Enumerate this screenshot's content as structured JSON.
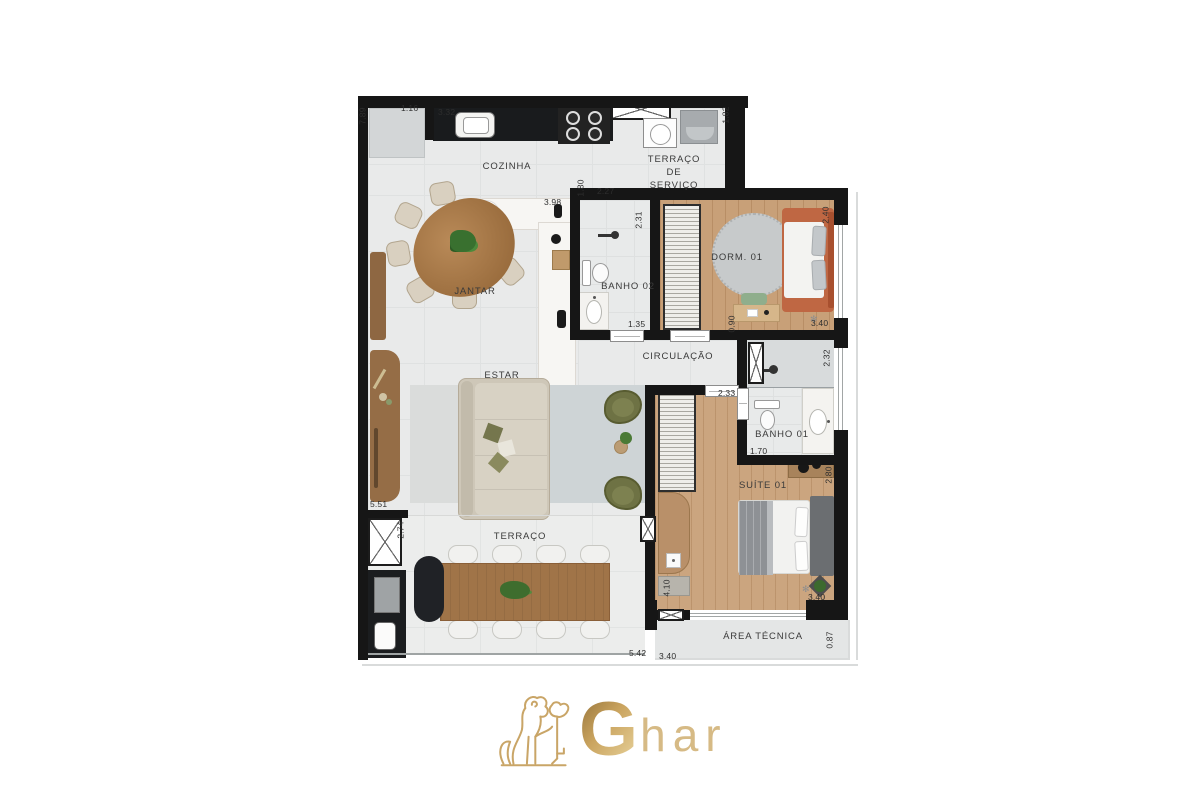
{
  "plan": {
    "rooms": {
      "cozinha": {
        "label": "COZINHA"
      },
      "terraco_servico": {
        "lines": [
          "TERRAÇO",
          "DE",
          "SERVIÇO"
        ]
      },
      "jantar": {
        "label": "JANTAR"
      },
      "banho02": {
        "label": "BANHO 02"
      },
      "dorm01": {
        "label": "DORM. 01"
      },
      "circulacao": {
        "label": "CIRCULAÇÃO"
      },
      "estar": {
        "label": "ESTAR"
      },
      "banho01": {
        "label": "BANHO 01"
      },
      "suite01": {
        "label": "SUÍTE 01"
      },
      "terraco": {
        "label": "TERRAÇO"
      },
      "area_tecnica": {
        "label": "ÁREA TÉCNICA"
      }
    },
    "dimensions_m": [
      "7.89",
      "1.16",
      "3.32",
      "1.82",
      "1.80",
      "2.27",
      "3.98",
      "2.31",
      "1.35",
      "2.40",
      "3.40",
      "0.90",
      "2.32",
      "2.33",
      "1.70",
      "2.80",
      "5.51",
      "2.74",
      "4.10",
      "3.40",
      "5.42",
      "3.40",
      "0.87"
    ],
    "colors": {
      "wall": "#161616",
      "floor_tile": "#e9eaea",
      "wood_floor": "#c8a078",
      "bed_accent": "#bf6743",
      "olive_chair": "#6e7244",
      "logo_gold": "#c9a567"
    }
  },
  "logo": {
    "g": "G",
    "har": "har"
  }
}
